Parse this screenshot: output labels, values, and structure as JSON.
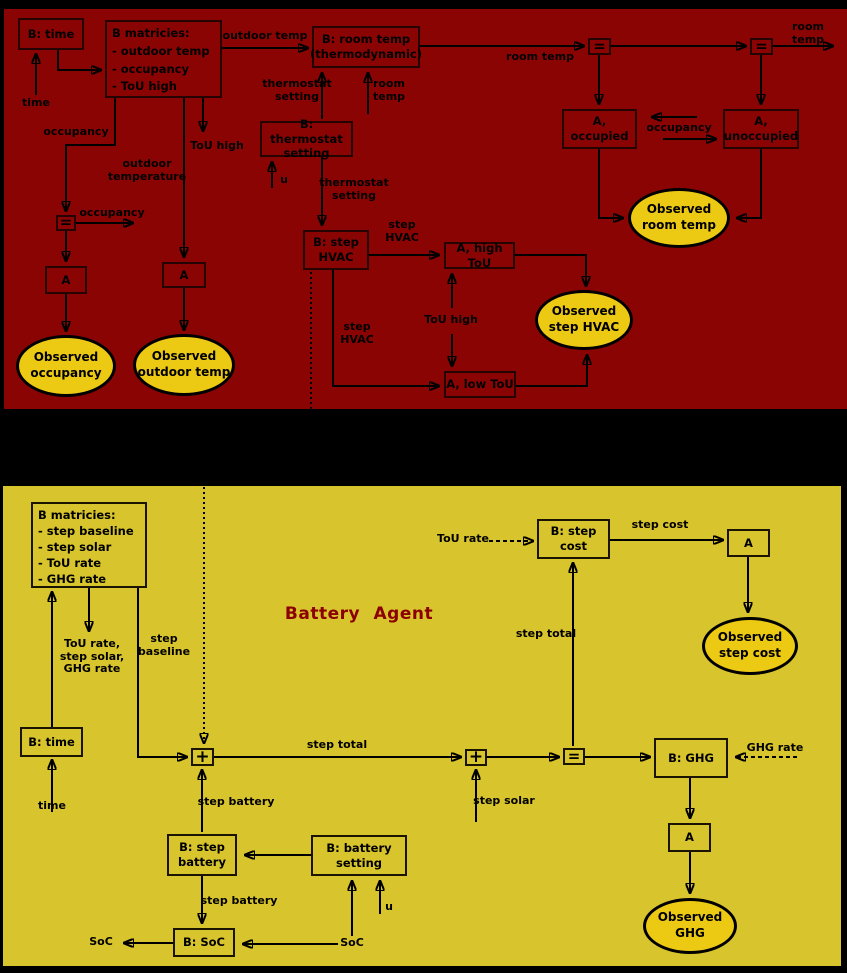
{
  "hvac_agent": {
    "nodes": {
      "b_time": "B: time",
      "b_matrices": "B matricies:\n - outdoor temp\n - occupancy\n - ToU high",
      "b_room_temp": "B: room temp\n(thermodynamic)",
      "eq1": "=",
      "eq2": "=",
      "eq3": "=",
      "a_occupied": "A,\noccupied",
      "a_unoccupied": "A,\nunoccupied",
      "b_thermostat_setting": "B: thermostat\nsetting",
      "a_occupancy": "A",
      "a_outdoor": "A",
      "b_step_hvac": "B: step\nHVAC",
      "a_high_tou": "A, high ToU",
      "a_low_tou": "A, low ToU"
    },
    "observed": {
      "occupancy": "Observed\noccupancy",
      "outdoor_temp": "Observed\noutdoor temp",
      "room_temp": "Observed\nroom temp",
      "step_hvac": "Observed\nstep HVAC"
    },
    "labels": {
      "time": "time",
      "outdoor_temp": "outdoor temp",
      "room_temp_mid": "room temp",
      "room_temp_out": "room temp",
      "occupancy_between": "occupancy",
      "occupancy_branch": "occupancy",
      "occupancy_eq": "occupancy",
      "outdoor_temperature": "outdoor\ntemperature",
      "tou_high_out": "ToU high",
      "thermostat_setting_up": "thermostat\nsetting",
      "room_temp_up": "room\ntemp",
      "u": "u",
      "thermostat_setting_down": "thermostat\nsetting",
      "step_hvac_right": "step\nHVAC",
      "step_hvac_down": "step\nHVAC",
      "tou_high_between": "ToU high"
    }
  },
  "battery_agent": {
    "title": "Battery Agent",
    "nodes": {
      "b_matrices": "B matricies:\n - step baseline\n - step solar\n - ToU rate\n - GHG rate",
      "b_step_cost": "B: step\ncost",
      "a_step_cost": "A",
      "b_time": "B: time",
      "plus1": "+",
      "plus2": "+",
      "eq": "=",
      "b_ghg": "B: GHG",
      "a_ghg": "A",
      "b_step_battery": "B: step\nbattery",
      "b_battery_setting": "B: battery\nsetting",
      "b_soc": "B: SoC"
    },
    "observed": {
      "step_cost": "Observed\nstep cost",
      "ghg": "Observed\nGHG"
    },
    "labels": {
      "matrices_outputs": "ToU rate,\nstep solar,\nGHG rate",
      "step_baseline": "step\nbaseline",
      "tou_rate": "ToU rate",
      "step_cost": "step cost",
      "step_total_vert": "step total",
      "step_total_horiz": "step total",
      "step_solar": "step solar",
      "ghg_rate": "GHG rate",
      "step_battery_up": "step battery",
      "step_battery_down": "step battery",
      "time": "time",
      "soc_left": "SoC",
      "soc_right": "SoC",
      "u": "u"
    }
  },
  "colors": {
    "hvac_background": "#8b0404",
    "battery_background": "#d8c42c",
    "observed_fill": "#ecc913",
    "title_color": "#8b0000"
  }
}
